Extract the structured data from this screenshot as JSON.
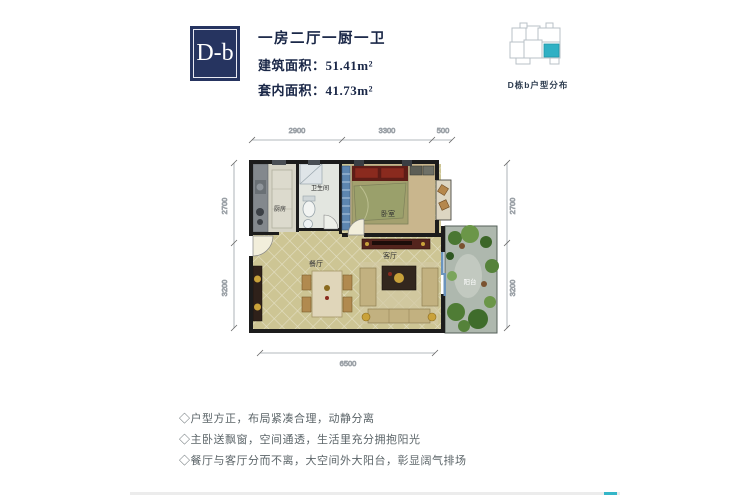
{
  "header": {
    "unit_code": "D-b",
    "layout_type": "一房二厅一厨一卫",
    "gross_area": "建筑面积：51.41m²",
    "net_area": "套内面积：41.73m²"
  },
  "locator": {
    "caption": "D栋b户型分布",
    "highlight_color": "#2fb0c4"
  },
  "plan": {
    "dims_top": [
      "2900",
      "3300",
      "500"
    ],
    "dims_left": [
      "2700",
      "3200"
    ],
    "dims_right": [
      "2700",
      "3200"
    ],
    "dim_bottom": "6500",
    "rooms": {
      "kitchen": "厨房",
      "bathroom": "卫生间",
      "bedroom": "卧室",
      "dining": "餐厅",
      "living": "客厅",
      "balcony": "阳台"
    }
  },
  "features": [
    "◇户型方正，布局紧凑合理，动静分离",
    "◇主卧送飘窗，空间通透，生活里充分拥抱阳光",
    "◇餐厅与客厅分而不离，大空间外大阳台，彰显阔气排场"
  ],
  "colors": {
    "brand_navy": "#263460",
    "accent_teal": "#35b6c8"
  }
}
